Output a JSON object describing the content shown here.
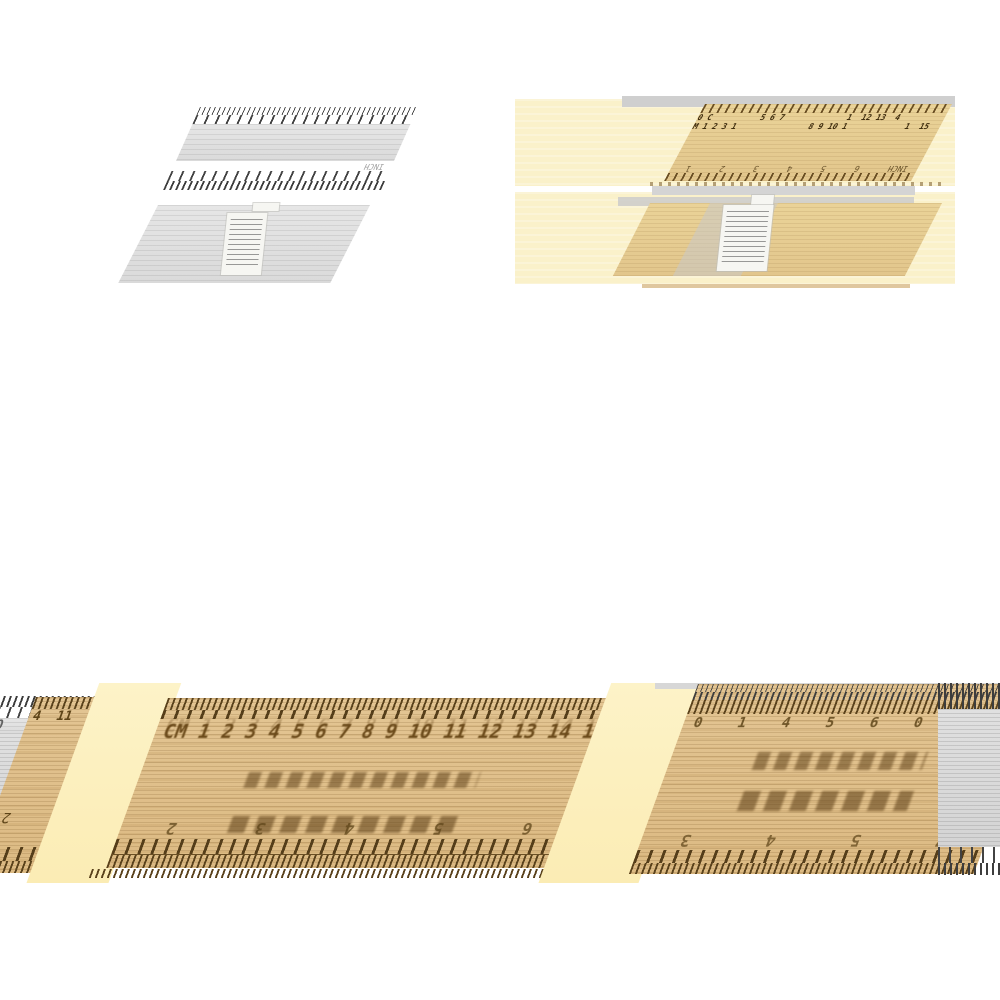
{
  "colors": {
    "background": "#ffffff",
    "pale_yellow_band": "#faf1ca",
    "yellow_wedge": "#fcefbe",
    "wood_light": "#e7cf9d",
    "wood_mid": "#ddbb84",
    "tick_brown": "#5a421c",
    "number_brown": "#6b4a1a",
    "gray_ruler_light": "#dedede",
    "gray_ruler_mid": "#d2d2d2",
    "tick_gray": "#454545",
    "label_white": "#f6f6f2"
  },
  "gray_thumb": {
    "front": {
      "inch_label": "INCH"
    }
  },
  "color_thumb": {
    "front": {
      "cm_row_1": "0 C          5 6 7             1  12 13  4",
      "cm_row_2": "M 1 2 3 1               8 9 10 1            1  15",
      "inch_row": "INCH      6      5      4      3      2      1"
    }
  },
  "closeup": {
    "left_fragment": {
      "row_1": "10     2      4",
      "row_2": "4  11  5",
      "inch_label": "INCH",
      "stray_digit": "2"
    },
    "main": {
      "cm_tokens": [
        "CM",
        "1",
        "2",
        "3",
        "4",
        "5",
        "6",
        "7",
        "8",
        "9",
        "10",
        "11",
        "12",
        "13",
        "14",
        "15"
      ],
      "inch_tokens": [
        "2",
        "3",
        "4",
        "5",
        "6"
      ]
    },
    "right": {
      "top_tokens": [
        "0",
        "1",
        "4",
        "5",
        "6",
        "0",
        "10",
        "1"
      ],
      "inch_tokens": [
        "3",
        "4",
        "5",
        "7"
      ]
    }
  }
}
